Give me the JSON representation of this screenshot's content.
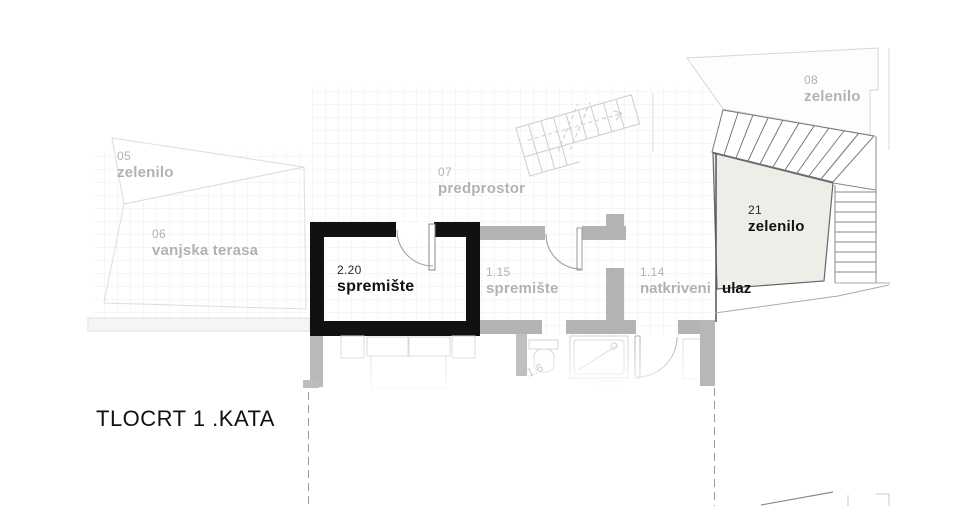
{
  "title": "TLOCRT 1 .KATA",
  "labels": {
    "a05": {
      "number": "05",
      "name": "zelenilo"
    },
    "a06": {
      "number": "06",
      "name": "vanjska terasa"
    },
    "a07": {
      "number": "07",
      "name": "predprostor"
    },
    "a08": {
      "number": "08",
      "name": "zelenilo"
    },
    "r220": {
      "number": "2.20",
      "name": "spremište"
    },
    "r115": {
      "number": "1.15",
      "name": "spremište"
    },
    "r114": {
      "number": "1.14",
      "name": "natkriveni",
      "name_emphasis": "ulaz"
    },
    "a21": {
      "number": "21",
      "name": "zelenilo"
    },
    "r16": {
      "number": "1.6"
    }
  },
  "colors": {
    "wall_black": "#111111",
    "wall_gray": "#b3b3b3",
    "label_gray": "#b2b2b2",
    "label_black": "#141414",
    "area21_fill": "#edeee8",
    "grid_line": "#ededed",
    "faint_outline": "#d8d8d8",
    "stair_stroke": "#777777",
    "dashed_cut_line": "#9a9a9a"
  }
}
